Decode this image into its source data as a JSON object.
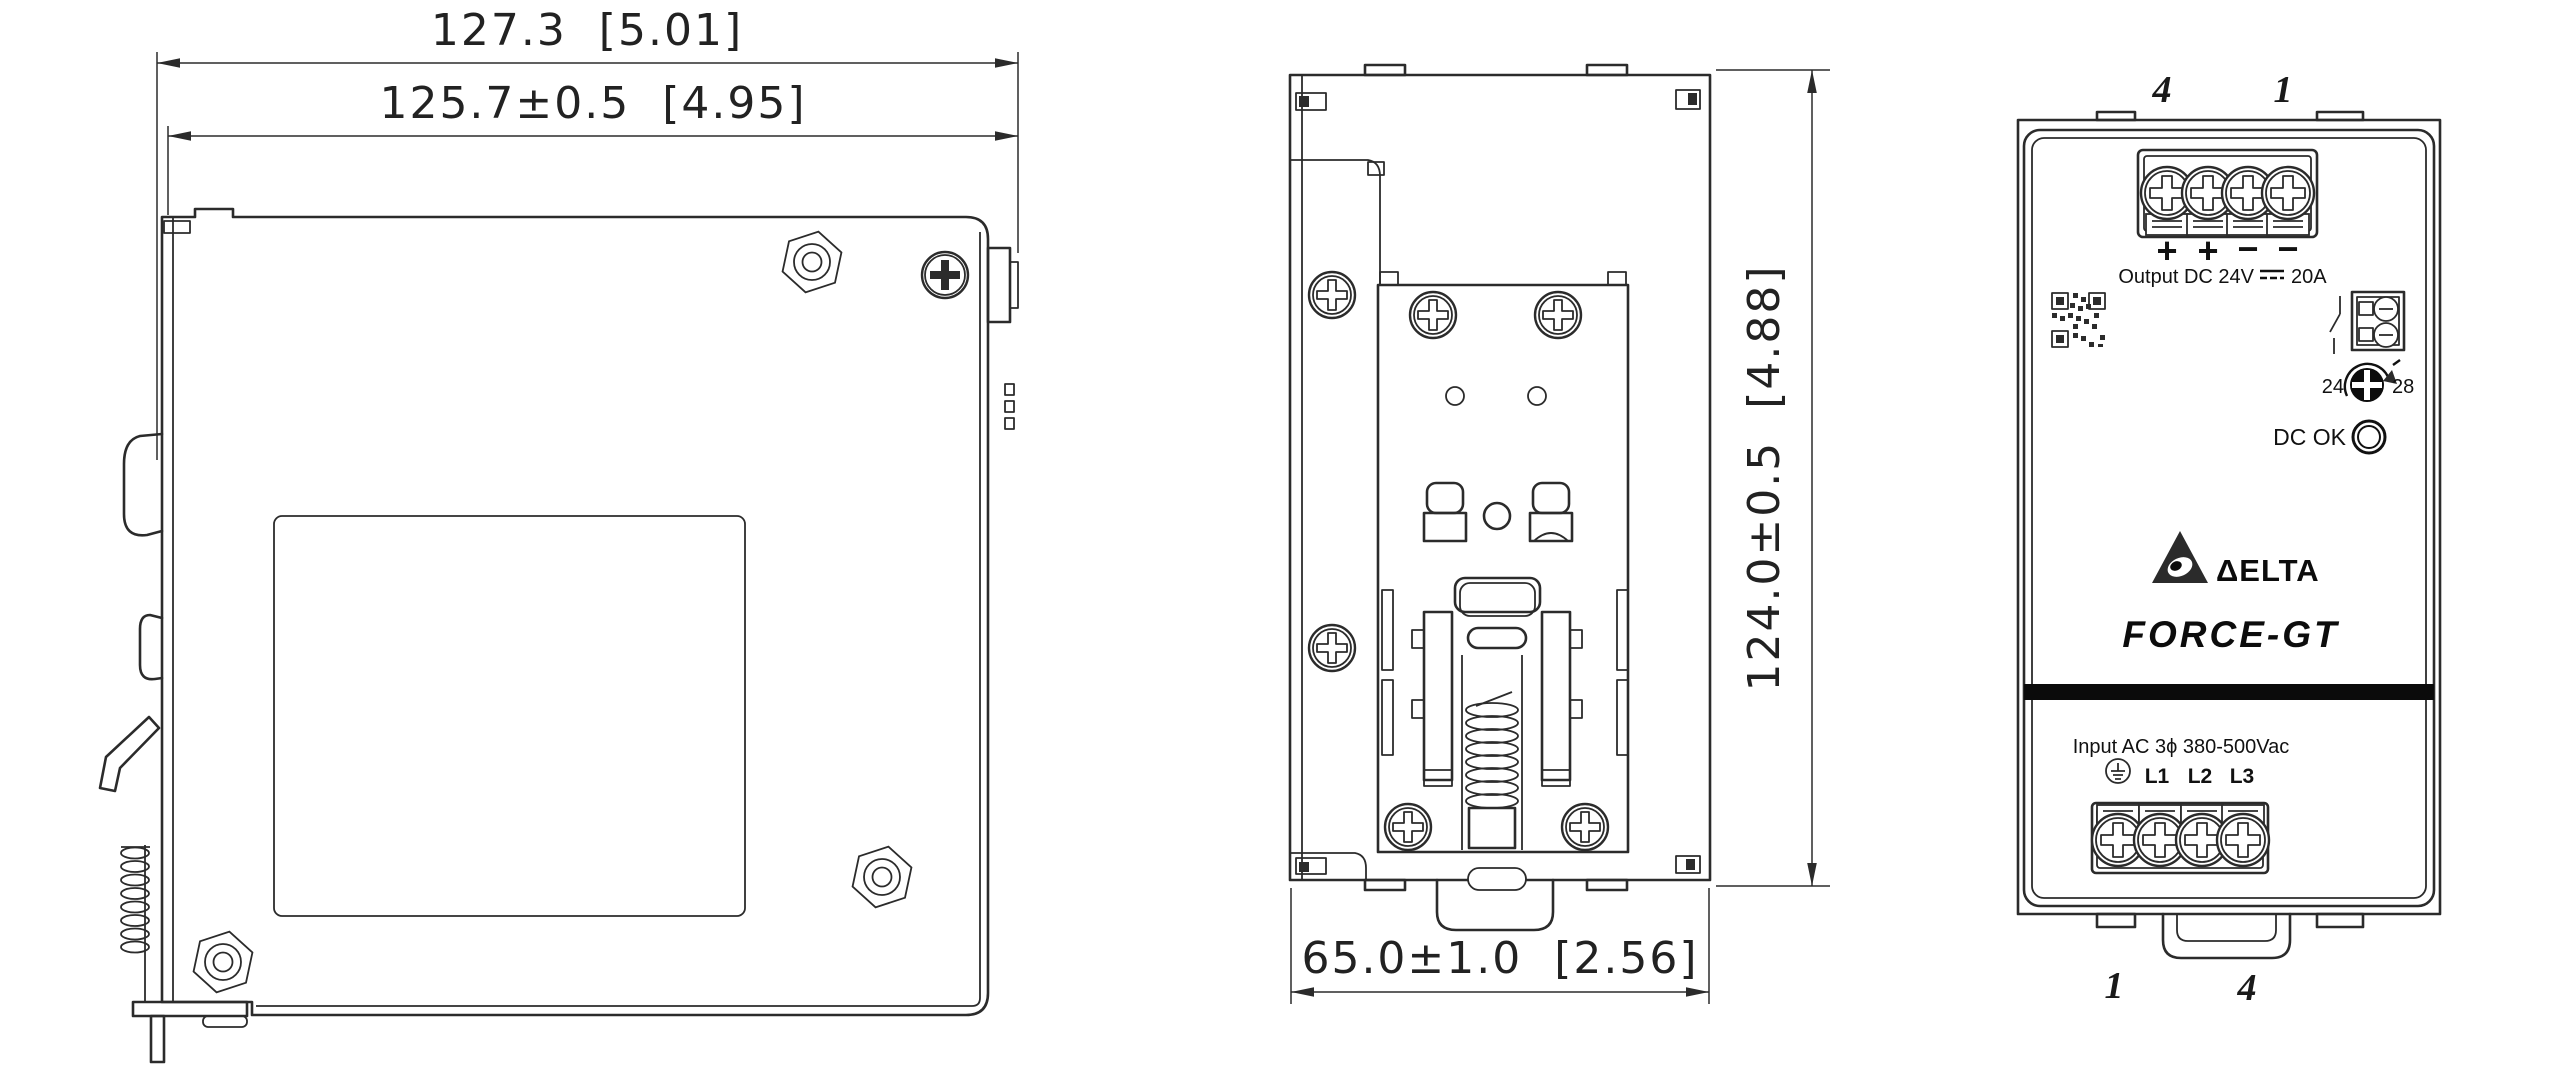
{
  "colors": {
    "line": "#2b2b2b",
    "band": "#0b0b0b"
  },
  "side_view": {
    "dim_overall": "127.3  [5.01]",
    "dim_body": "125.7±0.5  [4.95]"
  },
  "rear_view": {
    "dim_height": "124.0±0.5  [4.88]",
    "dim_width": "65.0±1.0  [2.56]"
  },
  "front_view": {
    "top_markers": [
      "4",
      "1"
    ],
    "bottom_markers": [
      "1",
      "4"
    ],
    "output": {
      "polarity": [
        "+",
        "+",
        "−",
        "−"
      ],
      "label": "Output DC 24V",
      "current": "20A"
    },
    "adjust": {
      "min": "24",
      "max": "28"
    },
    "dc_ok_label": "DC OK",
    "brand": "ΔELTA",
    "model": "FORCE-GT",
    "input": {
      "label": "Input AC 3ϕ 380-500Vac",
      "terminals": [
        "L1",
        "L2",
        "L3"
      ]
    }
  }
}
